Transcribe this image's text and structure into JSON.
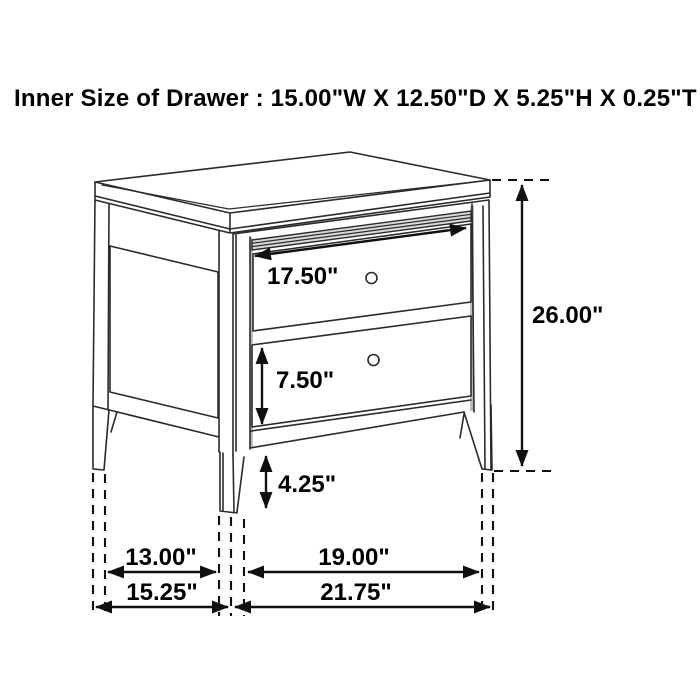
{
  "header": {
    "title": "Inner Size of Drawer : 15.00\"W X 12.50\"D X 5.25\"H X 0.25\"T"
  },
  "diagram": {
    "type": "furniture-dimension-line-drawing",
    "subject": "two-drawer nightstand with tapered legs and round knobs",
    "labels": {
      "top_drawer_width": "17.50\"",
      "overall_height": "26.00\"",
      "bottom_drawer_height": "7.50\"",
      "leg_height": "4.25\"",
      "side_leg_inner_span": "13.00\"",
      "front_leg_inner_span": "19.00\"",
      "side_outer_depth": "15.25\"",
      "front_outer_width": "21.75\""
    }
  },
  "colors": {
    "background": "#ffffff",
    "line": "#2b2b2b",
    "dim": "#101010",
    "text": "#000000",
    "shade": "#bdbdbd"
  }
}
